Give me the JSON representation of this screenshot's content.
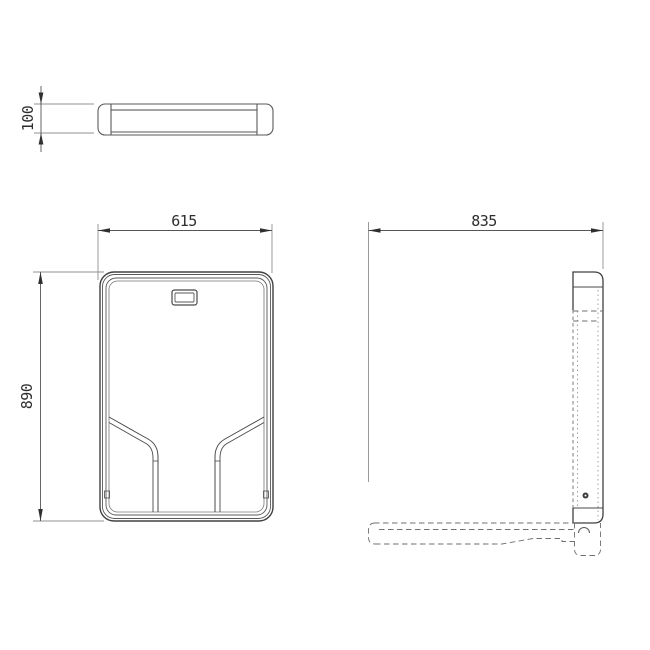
{
  "drawing": {
    "kind": "technical-orthographic-drawing",
    "background": "#ffffff",
    "outline_color": "#404040",
    "dimension_line_color": "#909090",
    "text_color": "#2d2d2d",
    "views": [
      "top-view",
      "front-view",
      "side-view",
      "folded-position-outline"
    ]
  },
  "dimensions": {
    "top_view_thickness": "100",
    "front_view_width": "615",
    "front_view_height": "890",
    "side_view_depth": "835"
  }
}
